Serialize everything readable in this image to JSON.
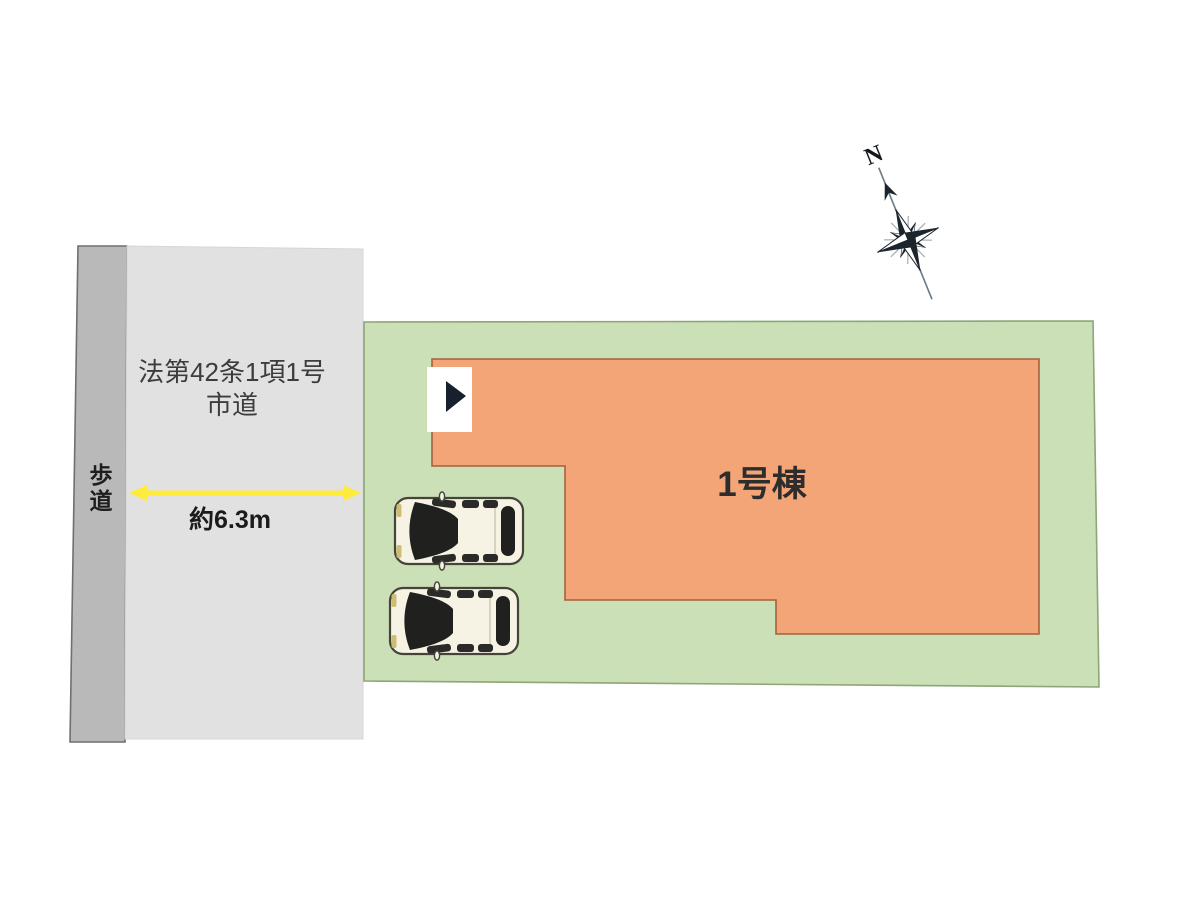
{
  "site_plan": {
    "road": {
      "name_line1": "法第42条1項1号",
      "name_line2": "市道",
      "fill": "#e1e1e1"
    },
    "sidewalk": {
      "label": "歩道",
      "fill": "#b9b9b9"
    },
    "dimension": {
      "label": "約6.3m",
      "arrow_color": "#ffec3a"
    },
    "lot": {
      "fill": "#cbe0b6"
    },
    "building": {
      "label": "1号棟",
      "fill": "#f3a577"
    },
    "compass": {
      "north_label": "N"
    },
    "cars": {
      "count": 2,
      "body_color": "#f6f3e4"
    }
  }
}
